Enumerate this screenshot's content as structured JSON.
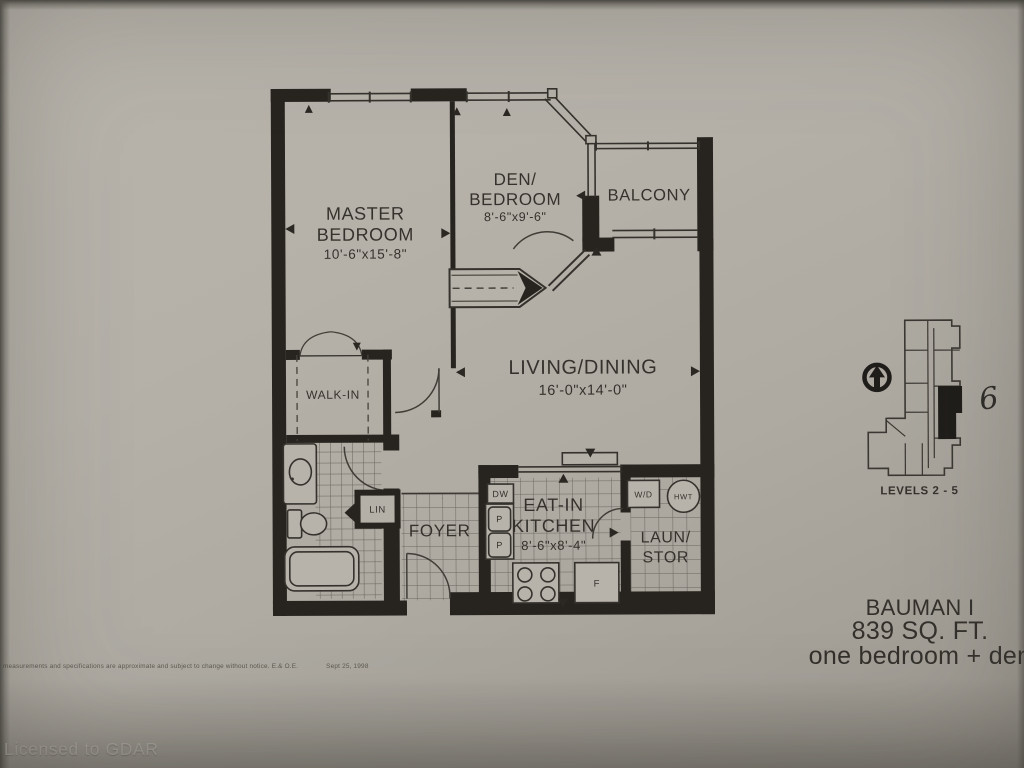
{
  "plan": {
    "master": {
      "line1": "MASTER",
      "line2": "BEDROOM",
      "dims": "10'-6\"x15'-8\""
    },
    "den": {
      "line1": "DEN/",
      "line2": "BEDROOM",
      "dims": "8'-6\"x9'-6\""
    },
    "balcony": {
      "name": "BALCONY"
    },
    "living": {
      "line1": "LIVING/DINING",
      "dims": "16'-0\"x14'-0\""
    },
    "walkin": {
      "name": "WALK-IN"
    },
    "lin": {
      "name": "LIN"
    },
    "foyer": {
      "name": "FOYER"
    },
    "kitchen": {
      "line1": "EAT-IN",
      "line2": "KITCHEN",
      "dims": "8'-6\"x8'-4\""
    },
    "laundry": {
      "line1": "LAUN/",
      "line2": "STOR"
    },
    "appliances": {
      "dw": "DW",
      "p1": "P",
      "p2": "P",
      "fridge": "F",
      "wd": "W/D",
      "hwt": "HWT"
    }
  },
  "keymap": {
    "levels": "LEVELS 2 - 5",
    "unit": "6"
  },
  "title_block": {
    "name": "BAUMAN I",
    "area": "839 SQ. FT.",
    "type": "one bedroom + den"
  },
  "footer": {
    "disclaimer": "measurements and specifications are approximate and subject to change without notice. E.& O.E.",
    "date": "Sept 25, 1998",
    "watermark": "Licensed to GDAR"
  },
  "colors": {
    "paper": "#b4b0a8",
    "ink": "#34312c",
    "wall": "#27241f",
    "watermark": "#c6c2ba"
  }
}
